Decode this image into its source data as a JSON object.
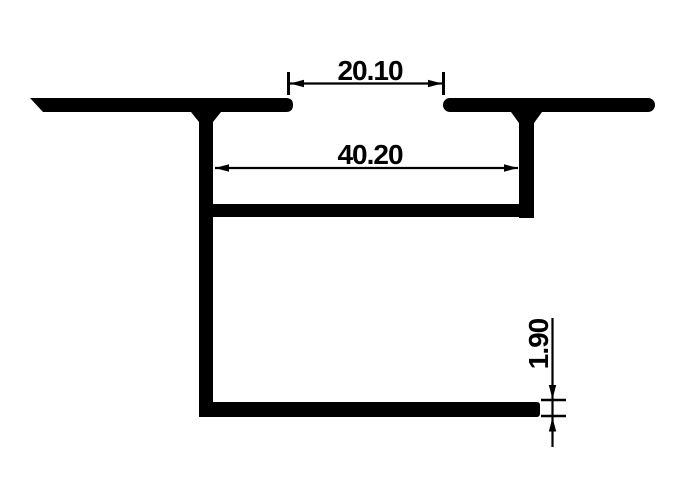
{
  "diagram": {
    "type": "technical-drawing",
    "subject": "aluminium-extrusion-profile-cross-section",
    "background_color": "#ffffff",
    "ink_color": "#000000",
    "dimensions": [
      {
        "id": "top-slot-gap",
        "label": "20.10",
        "orientation": "horizontal"
      },
      {
        "id": "inner-channel-width",
        "label": "40.20",
        "orientation": "horizontal"
      },
      {
        "id": "bottom-wall-thickness",
        "label": "1.90",
        "orientation": "vertical"
      }
    ]
  }
}
